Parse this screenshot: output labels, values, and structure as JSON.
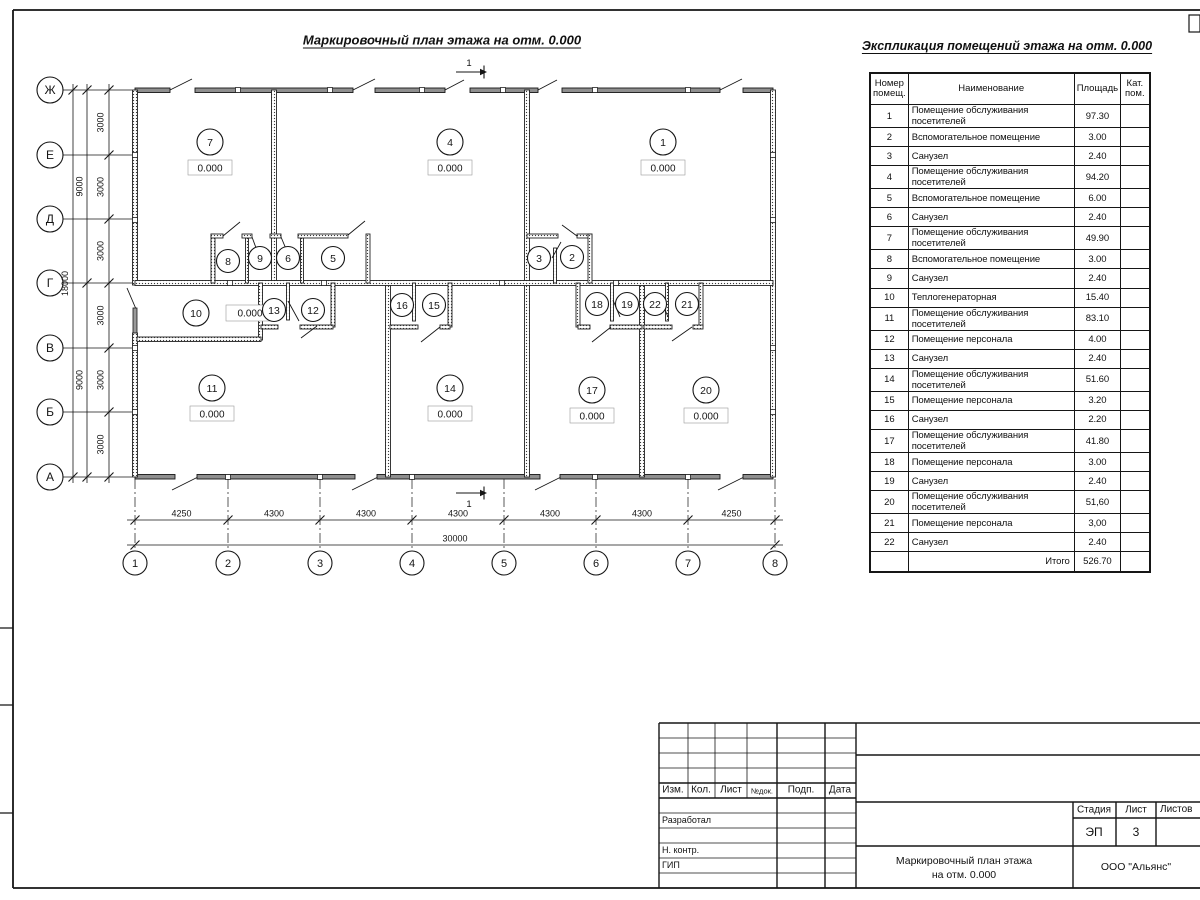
{
  "plan": {
    "title": "Маркировочный план этажа на отм. 0.000",
    "section_mark": "1",
    "elevation": "0.000",
    "axes_rows": [
      "Ж",
      "Е",
      "Д",
      "Г",
      "В",
      "Б",
      "А"
    ],
    "axes_cols": [
      "1",
      "2",
      "3",
      "4",
      "5",
      "6",
      "7",
      "8"
    ],
    "dims_left_inner": [
      "3000",
      "3000",
      "3000",
      "3000",
      "3000",
      "3000"
    ],
    "dims_left_mid": [
      "9000",
      "9000"
    ],
    "dim_left_total": "18000",
    "dims_bottom": [
      "4250",
      "4300",
      "4300",
      "4300",
      "4300",
      "4300",
      "4250"
    ],
    "dim_bottom_total": "30000",
    "rooms": [
      "1",
      "2",
      "3",
      "4",
      "5",
      "6",
      "7",
      "8",
      "9",
      "10",
      "11",
      "12",
      "13",
      "14",
      "15",
      "16",
      "17",
      "18",
      "19",
      "20",
      "21",
      "22"
    ]
  },
  "explication": {
    "title": "Экспликация помещений этажа на отм. 0.000",
    "headers": {
      "number": "Номер помещ.",
      "name": "Наименование",
      "area": "Площадь",
      "cat": "Кат. пом."
    },
    "rows": [
      [
        "1",
        "Помещение обслуживания посетителей",
        "97.30"
      ],
      [
        "2",
        "Вспомогательное помещение",
        "3.00"
      ],
      [
        "3",
        "Санузел",
        "2.40"
      ],
      [
        "4",
        "Помещение обслуживания посетителей",
        "94.20"
      ],
      [
        "5",
        "Вспомогательное помещение",
        "6.00"
      ],
      [
        "6",
        "Санузел",
        "2.40"
      ],
      [
        "7",
        "Помещение обслуживания посетителей",
        "49.90"
      ],
      [
        "8",
        "Вспомогательное помещение",
        "3.00"
      ],
      [
        "9",
        "Санузел",
        "2.40"
      ],
      [
        "10",
        "Теплогенераторная",
        "15.40"
      ],
      [
        "11",
        "Помещение обслуживания посетителей",
        "83.10"
      ],
      [
        "12",
        "Помещение персонала",
        "4.00"
      ],
      [
        "13",
        "Санузел",
        "2.40"
      ],
      [
        "14",
        "Помещение обслуживания посетителей",
        "51.60"
      ],
      [
        "15",
        "Помещение персонала",
        "3.20"
      ],
      [
        "16",
        "Санузел",
        "2.20"
      ],
      [
        "17",
        "Помещение обслуживания посетителей",
        "41.80"
      ],
      [
        "18",
        "Помещение персонала",
        "3.00"
      ],
      [
        "19",
        "Санузел",
        "2.40"
      ],
      [
        "20",
        "Помещение обслуживания посетителей",
        "51,60"
      ],
      [
        "21",
        "Помещение персонала",
        "3,00"
      ],
      [
        "22",
        "Санузел",
        "2.40"
      ]
    ],
    "total_label": "Итого",
    "total_value": "526.70"
  },
  "title_block": {
    "col_izm": "Изм.",
    "col_kol": "Кол.",
    "col_list": "Лист",
    "col_ndok": "№док.",
    "col_podp": "Подп.",
    "col_data": "Дата",
    "role_developed": "Разработал",
    "role_ncontr": "Н. контр.",
    "role_gip": "ГИП",
    "stage_label": "Стадия",
    "sheet_label": "Лист",
    "sheets_label": "Листов",
    "stage_value": "ЭП",
    "sheet_value": "3",
    "doc_title_line1": "Маркировочный план этажа",
    "doc_title_line2": "на отм. 0.000",
    "company": "ООО \"Альянс\""
  }
}
